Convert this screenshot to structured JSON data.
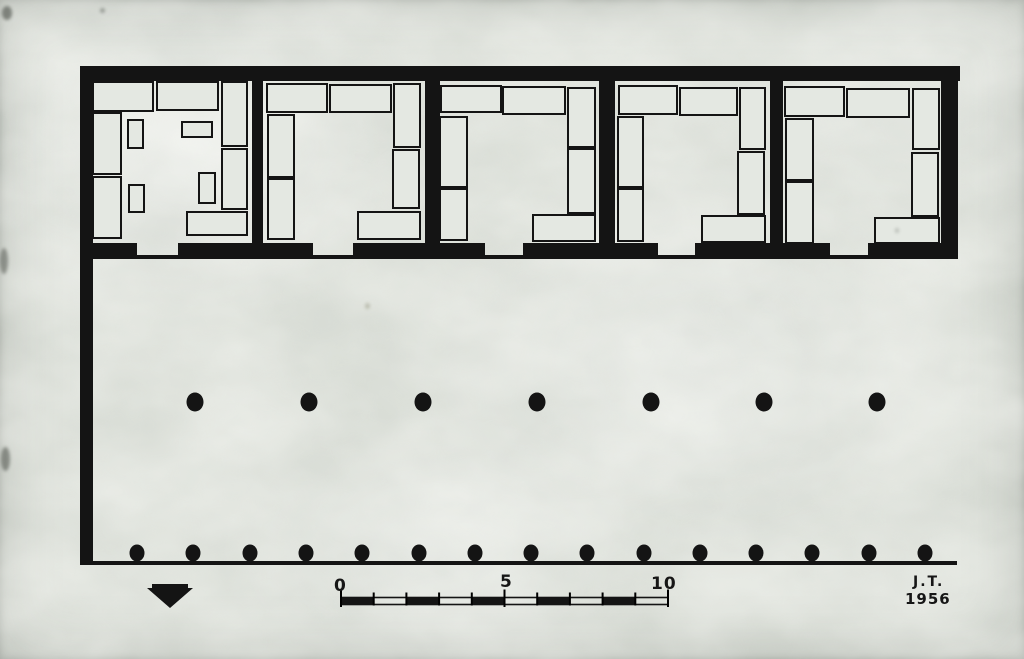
{
  "drawing": {
    "kind": "floor-plan",
    "ink": "#141414",
    "paper": "#dbdfd8",
    "slab_fill": "#e4e8e2"
  },
  "building": {
    "walls": [
      {
        "name": "north-wall",
        "rect": [
          80,
          66,
          880,
          15
        ]
      },
      {
        "name": "west-wall",
        "rect": [
          80,
          66,
          13,
          499
        ]
      },
      {
        "name": "east-wall",
        "rect": [
          941,
          66,
          17,
          192
        ]
      }
    ],
    "divider_walls": [
      {
        "name": "divider-wall-1",
        "rect": [
          252,
          80,
          11,
          177
        ]
      },
      {
        "name": "divider-wall-2",
        "rect": [
          425,
          80,
          15,
          177
        ]
      },
      {
        "name": "divider-wall-3",
        "rect": [
          599,
          80,
          16,
          177
        ]
      },
      {
        "name": "divider-wall-4",
        "rect": [
          770,
          80,
          13,
          177
        ]
      }
    ],
    "front_wall_segments": [
      [
        80,
        243,
        57,
        14
      ],
      [
        178,
        243,
        135,
        14
      ],
      [
        353,
        243,
        132,
        14
      ],
      [
        523,
        243,
        135,
        14
      ],
      [
        695,
        243,
        135,
        14
      ],
      [
        868,
        243,
        90,
        14
      ]
    ],
    "doorway_gaps_x": [
      [
        137,
        178
      ],
      [
        313,
        353
      ],
      [
        485,
        523
      ],
      [
        658,
        695
      ],
      [
        830,
        868
      ]
    ],
    "threshold_line": [
      80,
      255,
      878,
      4
    ],
    "rooms": [
      {
        "name": "room-1",
        "slabs": [
          [
            93,
            82,
            60,
            29
          ],
          [
            157,
            82,
            61,
            28
          ],
          [
            222,
            82,
            25,
            64
          ],
          [
            93,
            113,
            28,
            61
          ],
          [
            93,
            177,
            28,
            61
          ],
          [
            128,
            120,
            15,
            28
          ],
          [
            129,
            185,
            15,
            27
          ],
          [
            182,
            122,
            30,
            15
          ],
          [
            199,
            173,
            16,
            30
          ],
          [
            222,
            149,
            25,
            60
          ],
          [
            187,
            212,
            60,
            23
          ]
        ]
      },
      {
        "name": "room-2",
        "slabs": [
          [
            267,
            84,
            60,
            28
          ],
          [
            330,
            85,
            61,
            27
          ],
          [
            394,
            84,
            26,
            63
          ],
          [
            268,
            115,
            26,
            62
          ],
          [
            268,
            179,
            26,
            60
          ],
          [
            393,
            150,
            26,
            58
          ],
          [
            358,
            212,
            62,
            27
          ]
        ]
      },
      {
        "name": "room-3",
        "slabs": [
          [
            441,
            86,
            60,
            26
          ],
          [
            503,
            87,
            62,
            27
          ],
          [
            568,
            88,
            27,
            59
          ],
          [
            440,
            117,
            27,
            70
          ],
          [
            440,
            189,
            27,
            51
          ],
          [
            568,
            149,
            27,
            64
          ],
          [
            533,
            215,
            62,
            26
          ]
        ]
      },
      {
        "name": "room-4",
        "slabs": [
          [
            619,
            86,
            58,
            28
          ],
          [
            680,
            88,
            57,
            27
          ],
          [
            740,
            88,
            25,
            61
          ],
          [
            618,
            117,
            25,
            70
          ],
          [
            618,
            189,
            25,
            52
          ],
          [
            738,
            152,
            26,
            62
          ],
          [
            702,
            216,
            63,
            26
          ]
        ]
      },
      {
        "name": "room-5",
        "slabs": [
          [
            785,
            87,
            59,
            29
          ],
          [
            847,
            89,
            62,
            28
          ],
          [
            913,
            89,
            26,
            60
          ],
          [
            786,
            119,
            27,
            61
          ],
          [
            786,
            182,
            27,
            61
          ],
          [
            912,
            153,
            26,
            63
          ],
          [
            875,
            218,
            64,
            25
          ]
        ]
      }
    ]
  },
  "colonnades": {
    "inner_row": {
      "cy": 402,
      "rx": 8.5,
      "ry": 9.5,
      "cx": [
        195,
        309,
        423,
        537,
        651,
        764,
        877
      ]
    },
    "outer_row": {
      "cy": 553,
      "rx": 7.5,
      "ry": 8.5,
      "cx": [
        137,
        193,
        250,
        306,
        362,
        419,
        475,
        531,
        587,
        644,
        700,
        756,
        812,
        869,
        925
      ]
    },
    "stylobate_line": [
      80,
      561,
      877,
      4
    ]
  },
  "scale_bar": {
    "labels": [
      "0",
      "5",
      "10"
    ],
    "x_start": 341,
    "y": 597.5,
    "unit_px": 32.7,
    "units": 10,
    "bar_height": 7,
    "major_every": 5,
    "dark_first": true
  },
  "north_marker": {
    "points": "152,584 188,584 188,588 193,588 170,608 147,588 152,588"
  },
  "signature": {
    "initials": "J.T.",
    "year": "1956"
  }
}
